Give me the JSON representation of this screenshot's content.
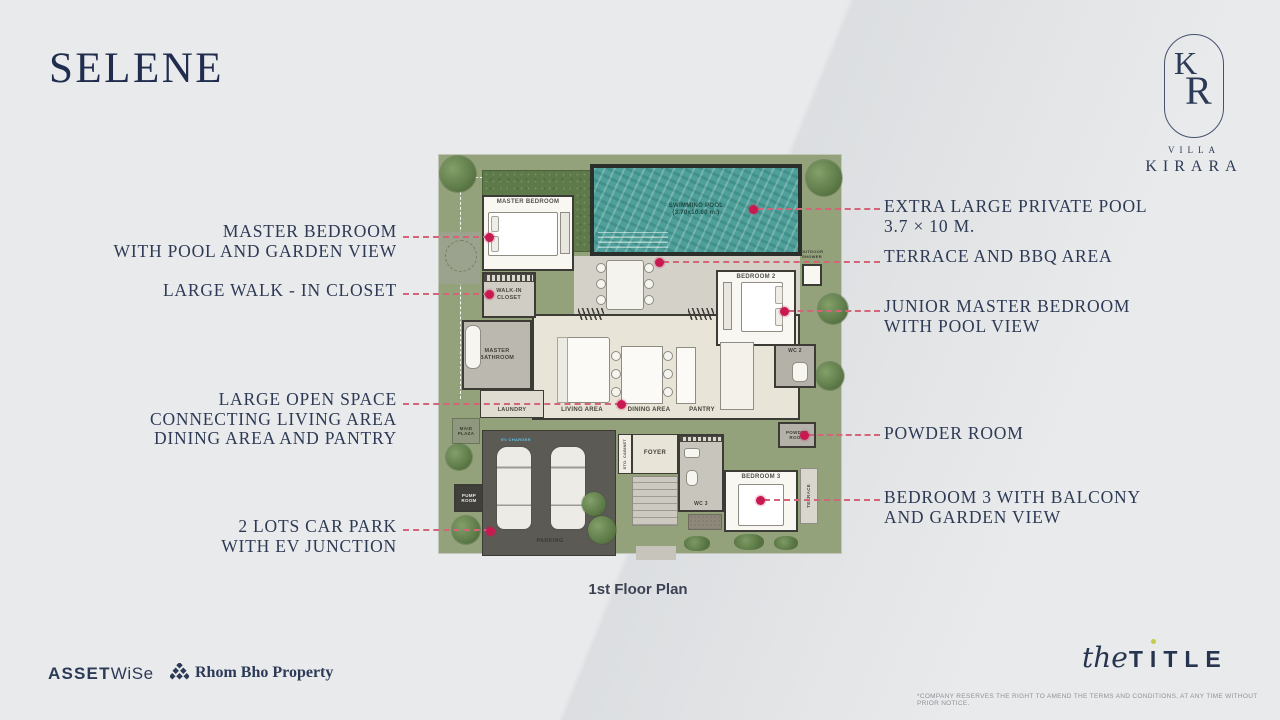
{
  "title": "SELENE",
  "caption": "1st Floor Plan",
  "logo": {
    "k": "K",
    "r": "R",
    "villa": "VILLA",
    "name": "KIRARA"
  },
  "callouts": {
    "left": [
      {
        "text": "MASTER BEDROOM\nWITH POOL AND GARDEN VIEW",
        "top": 222
      },
      {
        "text": "LARGE WALK - IN CLOSET",
        "top": 281
      },
      {
        "text": "LARGE OPEN SPACE\nCONNECTING LIVING AREA\nDINING AREA AND PANTRY",
        "top": 390
      },
      {
        "text": "2 LOTS CAR PARK\nWITH EV JUNCTION",
        "top": 517
      }
    ],
    "right": [
      {
        "text": "EXTRA LARGE PRIVATE POOL\n3.7 × 10 M.",
        "top": 197
      },
      {
        "text": "TERRACE AND BBQ AREA",
        "top": 247
      },
      {
        "text": "JUNIOR MASTER BEDROOM\nWITH POOL VIEW",
        "top": 297
      },
      {
        "text": "POWDER ROOM",
        "top": 424
      },
      {
        "text": "BEDROOM 3 WITH BALCONY\nAND GARDEN VIEW",
        "top": 488
      }
    ]
  },
  "footer": {
    "assetwise1": "ASSET",
    "assetwise2": "WiSe",
    "rhombho": "Rhom Bho Property",
    "title_script": "the",
    "title_t1": "T",
    "title_i": "I",
    "title_rest": "TLE",
    "disclaimer": "*COMPANY RESERVES THE RIGHT TO AMEND THE TERMS AND CONDITIONS, AT ANY TIME WITHOUT PRIOR NOTICE."
  },
  "colors": {
    "accent_red": "#c81950",
    "leader_pink": "#d26577",
    "navy": "#2e3a55",
    "pool": "#4fa09a"
  },
  "plan": {
    "areas": [
      {
        "id": "plot",
        "x": 0,
        "y": 6,
        "w": 404,
        "h": 400,
        "bg": "#93a27b",
        "cls": "grass",
        "border": "1px solid #c2c6b8"
      },
      {
        "id": "boundary-top",
        "x": 22,
        "y": 29,
        "w": 132,
        "h": 1,
        "cls": "dash-h"
      },
      {
        "id": "boundary-left",
        "x": 22,
        "y": 29,
        "w": 1,
        "h": 222,
        "cls": "dash-v"
      },
      {
        "id": "walkway",
        "x": 1,
        "y": 84,
        "w": 41,
        "h": 52,
        "bg": "#9ba28e"
      },
      {
        "id": "walkway-circle",
        "x": 7,
        "y": 92,
        "w": 32,
        "h": 32,
        "cls": "circle-line"
      },
      {
        "id": "hedge",
        "x": 44,
        "y": 22,
        "w": 112,
        "h": 82,
        "cls": "hedge"
      },
      {
        "id": "pool-frame",
        "x": 152,
        "y": 16,
        "w": 212,
        "h": 92,
        "bg": "#2c302c"
      },
      {
        "id": "pool",
        "x": 156,
        "y": 20,
        "w": 204,
        "h": 84,
        "cls": "water",
        "label": "SWIMMING POOL\n(3.70x10.00 m.)",
        "fs": 6,
        "color": "#1d4843"
      },
      {
        "id": "pool-steps",
        "x": 160,
        "y": 84,
        "w": 70,
        "h": 16,
        "cls": "steps-lines"
      },
      {
        "id": "master-bedroom",
        "x": 44,
        "y": 47,
        "w": 92,
        "h": 76,
        "bg": "#f8f7f2",
        "cls": "wall",
        "label": "MASTER BEDROOM",
        "fs": 6,
        "color": "#55514a",
        "labelPos": "top"
      },
      {
        "id": "mb-bed",
        "x": 50,
        "y": 64,
        "w": 70,
        "h": 44,
        "bg": "#ffffff",
        "border": "1px solid #8f8c84",
        "radius": 2
      },
      {
        "id": "mb-pillow-1",
        "x": 53,
        "y": 68,
        "w": 8,
        "h": 16,
        "bg": "#efede7",
        "border": "1px solid #a8a59d",
        "radius": 2
      },
      {
        "id": "mb-pillow-2",
        "x": 53,
        "y": 88,
        "w": 8,
        "h": 16,
        "bg": "#efede7",
        "border": "1px solid #a8a59d",
        "radius": 2
      },
      {
        "id": "mb-bench",
        "x": 122,
        "y": 64,
        "w": 10,
        "h": 42,
        "bg": "#e9e6df",
        "border": "1px solid #8f8c84"
      },
      {
        "id": "terrace",
        "x": 136,
        "y": 108,
        "w": 226,
        "h": 58,
        "bg": "#d4d1c9"
      },
      {
        "id": "outdoor-table",
        "x": 168,
        "y": 112,
        "w": 38,
        "h": 50,
        "bg": "#f5f3ed",
        "border": "1px solid #8f8c84",
        "radius": 3
      },
      {
        "id": "chair-1",
        "x": 158,
        "y": 115,
        "w": 10,
        "h": 10,
        "cls": "chair"
      },
      {
        "id": "chair-2",
        "x": 158,
        "y": 131,
        "w": 10,
        "h": 10,
        "cls": "chair"
      },
      {
        "id": "chair-3",
        "x": 158,
        "y": 147,
        "w": 10,
        "h": 10,
        "cls": "chair"
      },
      {
        "id": "chair-4",
        "x": 206,
        "y": 115,
        "w": 10,
        "h": 10,
        "cls": "chair"
      },
      {
        "id": "chair-5",
        "x": 206,
        "y": 131,
        "w": 10,
        "h": 10,
        "cls": "chair"
      },
      {
        "id": "chair-6",
        "x": 206,
        "y": 147,
        "w": 10,
        "h": 10,
        "cls": "chair"
      },
      {
        "id": "outdoor-shower-label",
        "x": 348,
        "y": 100,
        "w": 52,
        "h": 14,
        "label": "OUTDOOR\nSHOWER",
        "fs": 4,
        "color": "#3e3c38"
      },
      {
        "id": "outdoor-shower",
        "x": 364,
        "y": 116,
        "w": 20,
        "h": 22,
        "bg": "#f8f7f2",
        "cls": "wall"
      },
      {
        "id": "open-space",
        "x": 94,
        "y": 166,
        "w": 268,
        "h": 106,
        "bg": "#e9e4d8",
        "cls": "wall"
      },
      {
        "id": "door-1",
        "x": 140,
        "y": 160,
        "w": 26,
        "h": 12,
        "cls": "zigzag"
      },
      {
        "id": "door-2",
        "x": 250,
        "y": 160,
        "w": 26,
        "h": 12,
        "cls": "zigzag"
      },
      {
        "id": "bedroom2",
        "x": 278,
        "y": 122,
        "w": 80,
        "h": 76,
        "bg": "#f8f7f2",
        "cls": "wall",
        "label": "BEDROOM 2",
        "fs": 6,
        "color": "#55514a",
        "labelPos": "top"
      },
      {
        "id": "b2-bench",
        "x": 285,
        "y": 134,
        "w": 9,
        "h": 48,
        "bg": "#e9e6df",
        "border": "1px solid #8f8c84"
      },
      {
        "id": "b2-bed",
        "x": 303,
        "y": 134,
        "w": 42,
        "h": 50,
        "bg": "#ffffff",
        "border": "1px solid #8f8c84",
        "radius": 2
      },
      {
        "id": "b2-pillow-1",
        "x": 337,
        "y": 138,
        "w": 8,
        "h": 18,
        "bg": "#efede7",
        "border": "1px solid #a8a59d",
        "radius": 2
      },
      {
        "id": "b2-pillow-2",
        "x": 337,
        "y": 160,
        "w": 8,
        "h": 18,
        "bg": "#efede7",
        "border": "1px solid #a8a59d",
        "radius": 2
      },
      {
        "id": "walkin-closet",
        "x": 44,
        "y": 124,
        "w": 54,
        "h": 46,
        "bg": "#d0cdc4",
        "cls": "wall",
        "label": "WALK-IN\nCLOSET",
        "fs": 5.5,
        "color": "#4a4740"
      },
      {
        "id": "walkin-shelf",
        "x": 46,
        "y": 126,
        "w": 50,
        "h": 8,
        "cls": "shelves"
      },
      {
        "id": "master-bathroom",
        "x": 24,
        "y": 172,
        "w": 70,
        "h": 70,
        "bg": "#bbb8b0",
        "cls": "wall",
        "label": "MASTER\nBATHROOM",
        "fs": 5.5,
        "color": "#45423c"
      },
      {
        "id": "bathtub",
        "x": 27,
        "y": 177,
        "w": 16,
        "h": 44,
        "bg": "#f7f5ef",
        "border": "1px solid #8f8c84",
        "radius": 7
      },
      {
        "id": "laundry",
        "x": 42,
        "y": 242,
        "w": 64,
        "h": 28,
        "bg": "#e0dcd1",
        "cls": "wall-thin",
        "label": "LAUNDRY",
        "fs": 5.5,
        "color": "#4a4740",
        "labelPos": "bottom"
      },
      {
        "id": "sofa",
        "x": 119,
        "y": 189,
        "w": 53,
        "h": 66,
        "bg": "#fbfaf6",
        "border": "1px solid #8f8c84",
        "radius": 3
      },
      {
        "id": "sofa-back",
        "x": 119,
        "y": 189,
        "w": 11,
        "h": 66,
        "bg": "#ecebe3",
        "border": "1px solid #a8a59d"
      },
      {
        "id": "living-label",
        "x": 104,
        "y": 258,
        "w": 80,
        "h": 10,
        "label": "LIVING AREA",
        "fs": 6,
        "color": "#45423c"
      },
      {
        "id": "dining-table",
        "x": 183,
        "y": 198,
        "w": 42,
        "h": 58,
        "bg": "#fbfaf6",
        "border": "1px solid #8f8c84"
      },
      {
        "id": "chair-7",
        "x": 173,
        "y": 203,
        "w": 10,
        "h": 10,
        "cls": "chair"
      },
      {
        "id": "chair-8",
        "x": 173,
        "y": 221,
        "w": 10,
        "h": 10,
        "cls": "chair"
      },
      {
        "id": "chair-9",
        "x": 173,
        "y": 239,
        "w": 10,
        "h": 10,
        "cls": "chair"
      },
      {
        "id": "chair-10",
        "x": 225,
        "y": 203,
        "w": 10,
        "h": 10,
        "cls": "chair"
      },
      {
        "id": "chair-11",
        "x": 225,
        "y": 221,
        "w": 10,
        "h": 10,
        "cls": "chair"
      },
      {
        "id": "chair-12",
        "x": 225,
        "y": 239,
        "w": 10,
        "h": 10,
        "cls": "chair"
      },
      {
        "id": "dining-label",
        "x": 176,
        "y": 258,
        "w": 70,
        "h": 10,
        "label": "DINING AREA",
        "fs": 6,
        "color": "#45423c"
      },
      {
        "id": "pantry-island",
        "x": 238,
        "y": 199,
        "w": 20,
        "h": 57,
        "bg": "#fbfaf6",
        "border": "1px solid #8f8c84"
      },
      {
        "id": "pantry-label",
        "x": 236,
        "y": 258,
        "w": 56,
        "h": 10,
        "label": "PANTRY",
        "fs": 6,
        "color": "#45423c"
      },
      {
        "id": "kitchen-counter",
        "x": 282,
        "y": 194,
        "w": 34,
        "h": 68,
        "bg": "#f3f1ea",
        "border": "1px solid #8f8c84"
      },
      {
        "id": "wc2",
        "x": 336,
        "y": 196,
        "w": 42,
        "h": 44,
        "bg": "#b4b1a9",
        "cls": "wall",
        "label": "WC 2",
        "fs": 5,
        "color": "#403d38",
        "labelPos": "top"
      },
      {
        "id": "wc2-fixture",
        "x": 354,
        "y": 214,
        "w": 16,
        "h": 20,
        "bg": "#f7f5ef",
        "border": "1px solid #8f8c84",
        "radius": 5
      },
      {
        "id": "powder-room",
        "x": 340,
        "y": 274,
        "w": 38,
        "h": 26,
        "bg": "#b4b1a9",
        "cls": "wall",
        "label": "POWDER\nROOM",
        "fs": 4.5,
        "color": "#403d38"
      },
      {
        "id": "maid-plaza",
        "x": 14,
        "y": 270,
        "w": 28,
        "h": 26,
        "bg": "#8f987e",
        "border": "1px solid #6c7558",
        "label": "MAID\nPLAZA",
        "fs": 4.5,
        "color": "#383e30"
      },
      {
        "id": "pump-room",
        "x": 16,
        "y": 336,
        "w": 30,
        "h": 28,
        "bg": "#413f3b",
        "cls": "wall",
        "label": "PUMP\nROOM",
        "fs": 4.5,
        "color": "#e9e7e1"
      },
      {
        "id": "parking",
        "x": 44,
        "y": 282,
        "w": 134,
        "h": 126,
        "bg": "#5c5a54",
        "border": "1px solid #3b3a35"
      },
      {
        "id": "ev-charger-label",
        "x": 56,
        "y": 288,
        "w": 44,
        "h": 8,
        "label": "EV CHARGER",
        "fs": 4,
        "color": "#58c3e9"
      },
      {
        "id": "car-1",
        "x": 58,
        "y": 298,
        "w": 36,
        "h": 84,
        "cls": "car"
      },
      {
        "id": "car-2",
        "x": 112,
        "y": 298,
        "w": 36,
        "h": 84,
        "cls": "car"
      },
      {
        "id": "parking-label",
        "x": 72,
        "y": 388,
        "w": 80,
        "h": 10,
        "label": "PARKING",
        "fs": 5.5,
        "color": "#3c3a35"
      },
      {
        "id": "parking-bush",
        "x": 150,
        "y": 368,
        "w": 28,
        "h": 28,
        "cls": "tree"
      },
      {
        "id": "sto-cabinet",
        "x": 180,
        "y": 286,
        "w": 14,
        "h": 40,
        "bg": "#f0ede5",
        "cls": "wall-thin",
        "label": "STO. CABINET",
        "fs": 3.8,
        "color": "#4a4740",
        "vertical": true
      },
      {
        "id": "foyer",
        "x": 194,
        "y": 286,
        "w": 46,
        "h": 40,
        "bg": "#e9e4d8",
        "cls": "wall-thin",
        "label": "FOYER",
        "fs": 6,
        "color": "#45423c"
      },
      {
        "id": "wc3",
        "x": 240,
        "y": 286,
        "w": 46,
        "h": 78,
        "bg": "#c8c5bd",
        "cls": "wall",
        "label": "WC 3",
        "fs": 5,
        "color": "#403d38",
        "labelPos": "bottom"
      },
      {
        "id": "wc3-note",
        "x": 242,
        "y": 288,
        "w": 42,
        "h": 6,
        "cls": "shelves"
      },
      {
        "id": "wc3-sink",
        "x": 246,
        "y": 300,
        "w": 16,
        "h": 10,
        "bg": "#f7f5ef",
        "border": "1px solid #8f8c84",
        "radius": 3
      },
      {
        "id": "wc3-toilet",
        "x": 248,
        "y": 322,
        "w": 12,
        "h": 16,
        "bg": "#f7f5ef",
        "border": "1px solid #8f8c84",
        "radius": 5
      },
      {
        "id": "bedroom3",
        "x": 286,
        "y": 322,
        "w": 74,
        "h": 62,
        "bg": "#f8f7f2",
        "cls": "wall",
        "label": "BEDROOM 3",
        "fs": 6,
        "color": "#55514a",
        "labelPos": "top"
      },
      {
        "id": "b3-bed",
        "x": 300,
        "y": 336,
        "w": 46,
        "h": 42,
        "bg": "#ffffff",
        "border": "1px solid #8f8c84",
        "radius": 2
      },
      {
        "id": "terrace-3",
        "x": 362,
        "y": 320,
        "w": 18,
        "h": 56,
        "bg": "#d9d6ce",
        "border": "1px solid #8f8c84",
        "label": "TERRACE",
        "fs": 4.5,
        "color": "#54514b",
        "vertical": true
      },
      {
        "id": "entry-steps",
        "x": 194,
        "y": 328,
        "w": 46,
        "h": 50,
        "cls": "steps2"
      },
      {
        "id": "entry-path",
        "x": 198,
        "y": 398,
        "w": 40,
        "h": 14,
        "bg": "#c7c4bc"
      },
      {
        "id": "gravel",
        "x": 250,
        "y": 366,
        "w": 34,
        "h": 16,
        "cls": "gravel"
      },
      {
        "id": "tree-1",
        "x": 2,
        "y": 8,
        "w": 36,
        "h": 36,
        "cls": "tree"
      },
      {
        "id": "tree-2",
        "x": 368,
        "y": 12,
        "w": 36,
        "h": 36,
        "cls": "tree"
      },
      {
        "id": "tree-3",
        "x": 380,
        "y": 146,
        "w": 30,
        "h": 30,
        "cls": "tree"
      },
      {
        "id": "tree-4",
        "x": 378,
        "y": 214,
        "w": 28,
        "h": 28,
        "cls": "tree"
      },
      {
        "id": "tree-5",
        "x": 8,
        "y": 296,
        "w": 26,
        "h": 26,
        "cls": "tree"
      },
      {
        "id": "tree-6",
        "x": 14,
        "y": 368,
        "w": 28,
        "h": 28,
        "cls": "tree"
      },
      {
        "id": "tree-7",
        "x": 144,
        "y": 344,
        "w": 24,
        "h": 24,
        "cls": "tree"
      },
      {
        "id": "bush-1",
        "x": 246,
        "y": 388,
        "w": 26,
        "h": 15,
        "cls": "bush"
      },
      {
        "id": "bush-2",
        "x": 296,
        "y": 386,
        "w": 30,
        "h": 16,
        "cls": "bush"
      },
      {
        "id": "bush-3",
        "x": 336,
        "y": 388,
        "w": 24,
        "h": 14,
        "cls": "bush"
      }
    ],
    "markers": [
      {
        "x": 489,
        "y": 237
      },
      {
        "x": 753,
        "y": 209
      },
      {
        "x": 659,
        "y": 262
      },
      {
        "x": 489,
        "y": 294
      },
      {
        "x": 784,
        "y": 311
      },
      {
        "x": 621,
        "y": 404
      },
      {
        "x": 804,
        "y": 435
      },
      {
        "x": 760,
        "y": 500
      },
      {
        "x": 490,
        "y": 531
      }
    ],
    "leaders": [
      {
        "x": 403,
        "y": 237,
        "w": 86
      },
      {
        "x": 403,
        "y": 294,
        "w": 86
      },
      {
        "x": 403,
        "y": 404,
        "w": 218
      },
      {
        "x": 403,
        "y": 530,
        "w": 87
      },
      {
        "x": 757,
        "y": 209,
        "w": 123
      },
      {
        "x": 663,
        "y": 262,
        "w": 217
      },
      {
        "x": 788,
        "y": 311,
        "w": 92
      },
      {
        "x": 808,
        "y": 435,
        "w": 72
      },
      {
        "x": 764,
        "y": 500,
        "w": 116
      }
    ]
  }
}
